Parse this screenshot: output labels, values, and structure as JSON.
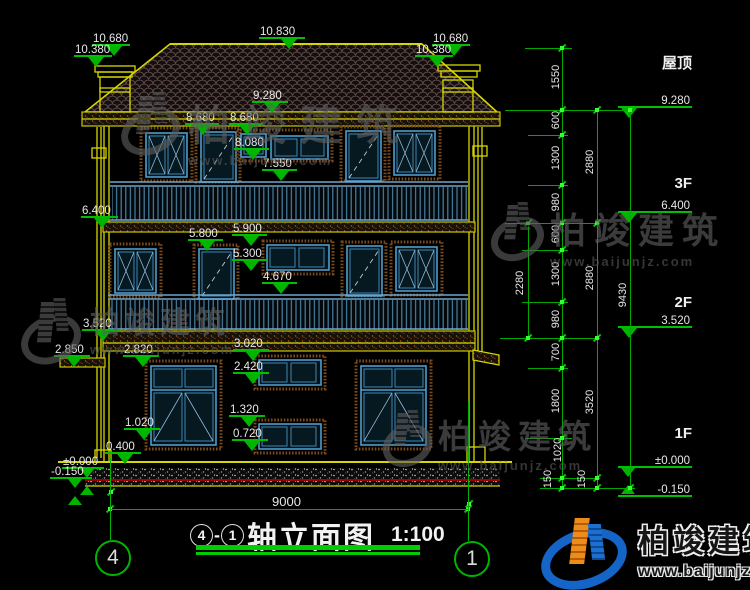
{
  "title": {
    "axis_from": "4",
    "separator": "-",
    "axis_to": "1",
    "name": "轴立面图",
    "scale": "1:100"
  },
  "watermark": {
    "name": "柏竣建筑",
    "url": "www.baijunjz.com"
  },
  "span_dim": {
    "value": "9000"
  },
  "axis_bubbles": [
    {
      "n": "4",
      "x": 95,
      "y": 540,
      "lx": 110,
      "ly1": 458,
      "ly2": 540
    },
    {
      "n": "1",
      "x": 454,
      "y": 541,
      "lx": 468,
      "ly1": 402,
      "ly2": 541
    }
  ],
  "floor_captions": [
    {
      "t": "屋顶",
      "x": 620,
      "y": 52
    },
    {
      "t": "3F",
      "x": 620,
      "y": 175
    },
    {
      "t": "2F",
      "x": 620,
      "y": 294
    },
    {
      "t": "1F",
      "x": 620,
      "y": 425
    }
  ],
  "levels": [
    {
      "t": "10.680",
      "x": 92,
      "y": 46,
      "w": 38
    },
    {
      "t": "10.380",
      "x": 74,
      "y": 57,
      "w": 38
    },
    {
      "t": "10.830",
      "x": 259,
      "y": 39,
      "w": 46
    },
    {
      "t": "10.680",
      "x": 432,
      "y": 46,
      "w": 38
    },
    {
      "t": "10.380",
      "x": 415,
      "y": 57,
      "w": 38
    },
    {
      "t": "9.280",
      "x": 252,
      "y": 103,
      "w": 36
    },
    {
      "t": "8.680",
      "x": 185,
      "y": 125,
      "w": 34
    },
    {
      "t": "8.680",
      "x": 229,
      "y": 125,
      "w": 34
    },
    {
      "t": "8.080",
      "x": 234,
      "y": 150,
      "w": 35
    },
    {
      "t": "7.550",
      "x": 262,
      "y": 171,
      "w": 35
    },
    {
      "t": "6.400",
      "x": 81,
      "y": 218,
      "w": 37
    },
    {
      "t": "5.800",
      "x": 188,
      "y": 241,
      "w": 35
    },
    {
      "t": "5.900",
      "x": 232,
      "y": 236,
      "w": 35
    },
    {
      "t": "5.300",
      "x": 232,
      "y": 261,
      "w": 35
    },
    {
      "t": "4.670",
      "x": 262,
      "y": 284,
      "w": 35
    },
    {
      "t": "3.520",
      "x": 82,
      "y": 331,
      "w": 37
    },
    {
      "t": "2.850",
      "x": 54,
      "y": 357,
      "w": 36
    },
    {
      "t": "2.820",
      "x": 123,
      "y": 357,
      "w": 36
    },
    {
      "t": "3.020",
      "x": 233,
      "y": 351,
      "w": 36
    },
    {
      "t": "2.420",
      "x": 233,
      "y": 374,
      "w": 36
    },
    {
      "t": "1.320",
      "x": 229,
      "y": 417,
      "w": 36
    },
    {
      "t": "1.020",
      "x": 124,
      "y": 430,
      "w": 36
    },
    {
      "t": "0.720",
      "x": 232,
      "y": 441,
      "w": 36
    },
    {
      "t": "0.400",
      "x": 105,
      "y": 454,
      "w": 36
    },
    {
      "t": "±0.000",
      "x": 62,
      "y": 469,
      "w": 42,
      "k": "x"
    },
    {
      "t": "-0.150",
      "x": 50,
      "y": 479,
      "w": 42,
      "k": "x"
    },
    {
      "t": "9.280",
      "x": 618,
      "y": 108,
      "w": 74,
      "dir": "l"
    },
    {
      "t": "6.400",
      "x": 618,
      "y": 213,
      "w": 74,
      "dir": "l"
    },
    {
      "t": "3.520",
      "x": 618,
      "y": 328,
      "w": 74,
      "dir": "l"
    },
    {
      "t": "±0.000",
      "x": 618,
      "y": 468,
      "w": 74,
      "dir": "l",
      "k": "x"
    },
    {
      "t": "-0.150",
      "x": 618,
      "y": 497,
      "w": 74,
      "dir": "l",
      "k": "none",
      "below": 1
    }
  ],
  "chains": {
    "vlines": [
      [
        562,
        48,
        488
      ],
      [
        597,
        110,
        488
      ],
      [
        630,
        110,
        488
      ],
      [
        528,
        223,
        338
      ]
    ],
    "hlines": [
      [
        525,
        48,
        572
      ],
      [
        505,
        110,
        635
      ],
      [
        528,
        135,
        568
      ],
      [
        528,
        185,
        568
      ],
      [
        505,
        223,
        600
      ],
      [
        522,
        250,
        568
      ],
      [
        522,
        302,
        568
      ],
      [
        500,
        338,
        600
      ],
      [
        528,
        368,
        568
      ],
      [
        525,
        438,
        572
      ],
      [
        540,
        478,
        600
      ],
      [
        540,
        488,
        635
      ]
    ],
    "labels": [
      {
        "v": "1550",
        "x": 556,
        "y": 79
      },
      {
        "v": "600",
        "x": 556,
        "y": 122
      },
      {
        "v": "1300",
        "x": 556,
        "y": 160
      },
      {
        "v": "980",
        "x": 556,
        "y": 204
      },
      {
        "v": "600",
        "x": 556,
        "y": 236
      },
      {
        "v": "1300",
        "x": 556,
        "y": 276
      },
      {
        "v": "980",
        "x": 556,
        "y": 321
      },
      {
        "v": "700",
        "x": 556,
        "y": 354
      },
      {
        "v": "1800",
        "x": 556,
        "y": 403
      },
      {
        "v": "1020",
        "x": 558,
        "y": 452
      },
      {
        "v": "150",
        "x": 548,
        "y": 481
      },
      {
        "v": "2880",
        "x": 590,
        "y": 164
      },
      {
        "v": "2880",
        "x": 590,
        "y": 280
      },
      {
        "v": "3520",
        "x": 590,
        "y": 404
      },
      {
        "v": "150",
        "x": 582,
        "y": 481
      },
      {
        "v": "9430",
        "x": 623,
        "y": 297
      },
      {
        "v": "2280",
        "x": 520,
        "y": 285
      }
    ],
    "grips": [
      [
        562,
        48
      ],
      [
        562,
        110
      ],
      [
        562,
        135
      ],
      [
        562,
        185
      ],
      [
        562,
        223
      ],
      [
        562,
        250
      ],
      [
        562,
        302
      ],
      [
        562,
        338
      ],
      [
        562,
        368
      ],
      [
        562,
        438
      ],
      [
        562,
        478
      ],
      [
        562,
        488
      ],
      [
        597,
        110
      ],
      [
        597,
        223
      ],
      [
        597,
        338
      ],
      [
        597,
        478
      ],
      [
        597,
        488
      ],
      [
        630,
        110
      ],
      [
        630,
        488
      ],
      [
        528,
        223
      ],
      [
        528,
        338
      ],
      [
        110,
        509
      ],
      [
        468,
        509
      ],
      [
        111,
        492
      ],
      [
        469,
        504
      ]
    ],
    "span_line": {
      "x1": 110,
      "x2": 468,
      "y": 509,
      "label_x": 272,
      "label_y": 494
    }
  },
  "watermarks_gray": [
    {
      "x": 120,
      "y": 92,
      "f": 42,
      "sp": 14,
      "lw": 60,
      "lh": 62
    },
    {
      "x": 20,
      "y": 298,
      "f": 30,
      "sp": 5,
      "lw": 62,
      "lh": 66
    },
    {
      "x": 490,
      "y": 202,
      "f": 36,
      "sp": 8,
      "lw": 52,
      "lh": 56
    },
    {
      "x": 382,
      "y": 410,
      "f": 33,
      "sp": 7,
      "lw": 48,
      "lh": 54
    }
  ],
  "brand_pos": {
    "x": 538,
    "y": 512
  },
  "title_pos": {
    "x": 190,
    "y": 513,
    "bars": [
      [
        196,
        545,
        224,
        5
      ],
      [
        196,
        552,
        224,
        3
      ]
    ]
  }
}
